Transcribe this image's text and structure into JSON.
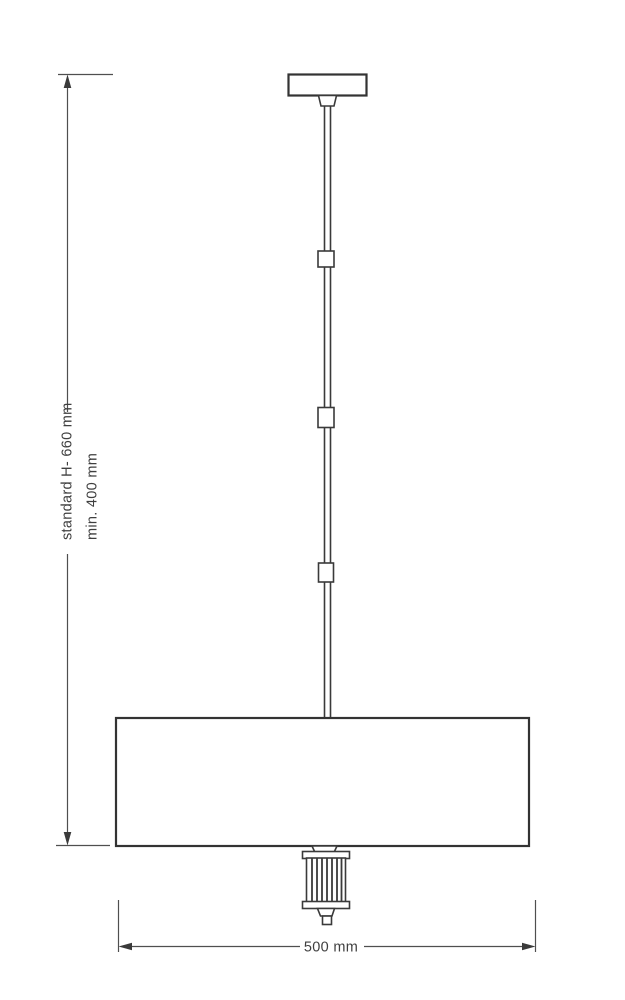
{
  "drawing": {
    "kind": "pendant-lamp-dimension-diagram"
  },
  "dimensions": {
    "standard_height": "standard H- 660 mm",
    "min_height": "min. 400 mm",
    "width": "500 mm"
  },
  "colors": {
    "background": "#ffffff",
    "fixture_line": "#3a3a3a",
    "shade_outline": "#333333",
    "dimension_line": "#4f4f4f",
    "label_text": "#3f3f3f"
  }
}
